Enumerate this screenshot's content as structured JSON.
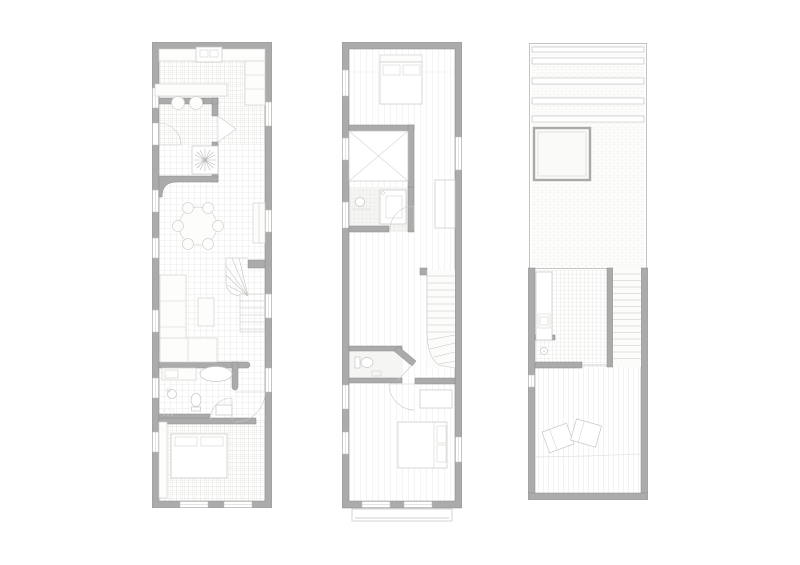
{
  "canvas": {
    "width": 800,
    "height": 565,
    "background": "#ffffff"
  },
  "palette": {
    "wall_fill": "#ababab",
    "wall_edge": "#8c8c8c",
    "win_frame": "#bdbdbb",
    "win_mull": "#c8c8c6",
    "furn_fill": "#fdfdfc",
    "furn_line": "#d2d2d0",
    "fixture_line": "#c6c6c4",
    "door_line": "#cccccb",
    "stair_line": "#c6c6c4",
    "plant_line": "#b9b9b7",
    "thin_line": "#c2c2c0",
    "floor_line": "#ecebe8",
    "deck_line": "#e8e7e4",
    "parapet": "#bdbdbb",
    "bg": "#ffffff"
  },
  "drawing": {
    "type": "architectural-floor-plans",
    "plans": [
      {
        "id": "ground-floor-plan",
        "position": "left",
        "rooms": [
          "kitchen",
          "entry-vestibule",
          "dining-area",
          "living-area",
          "bathroom",
          "bedroom"
        ],
        "fixtures": [
          "kitchen-counter",
          "sink-unit",
          "tall-counter",
          "kitchen-island",
          "bar-stools",
          "entry-door",
          "open-door-leaf",
          "planter-with-plant",
          "round-dining-table",
          "six-dining-chairs",
          "sideboard",
          "winder-stair",
          "l-shaped-sofa",
          "coffee-table",
          "bathtub",
          "vanity",
          "washbasin",
          "toilet",
          "washer-unit",
          "wardrobe-strip",
          "double-bed",
          "windows"
        ]
      },
      {
        "id": "first-floor-plan",
        "position": "middle",
        "rooms": [
          "front-bedroom",
          "skylight-shaft",
          "bathroom",
          "landing",
          "wc",
          "rear-bedroom"
        ],
        "fixtures": [
          "double-bed-with-pillows",
          "headboard",
          "void-with-cross",
          "washbasin",
          "shower",
          "wall-closet",
          "straight-stair",
          "winder-turn",
          "toilet",
          "door-arcs",
          "built-in-wardrobe",
          "rear-double-bed",
          "juliet-balcony",
          "windows"
        ]
      },
      {
        "id": "roof-plan",
        "position": "right",
        "rooms": [
          "front-roof",
          "roof-terrace",
          "stair-bulkhead",
          "outdoor-kitchen"
        ],
        "fixtures": [
          "pergola-slats",
          "skylight",
          "outdoor-counter",
          "appliance",
          "floor-drain",
          "roof-stair",
          "timber-deck",
          "two-lounge-chairs",
          "deck-seam"
        ]
      }
    ]
  }
}
